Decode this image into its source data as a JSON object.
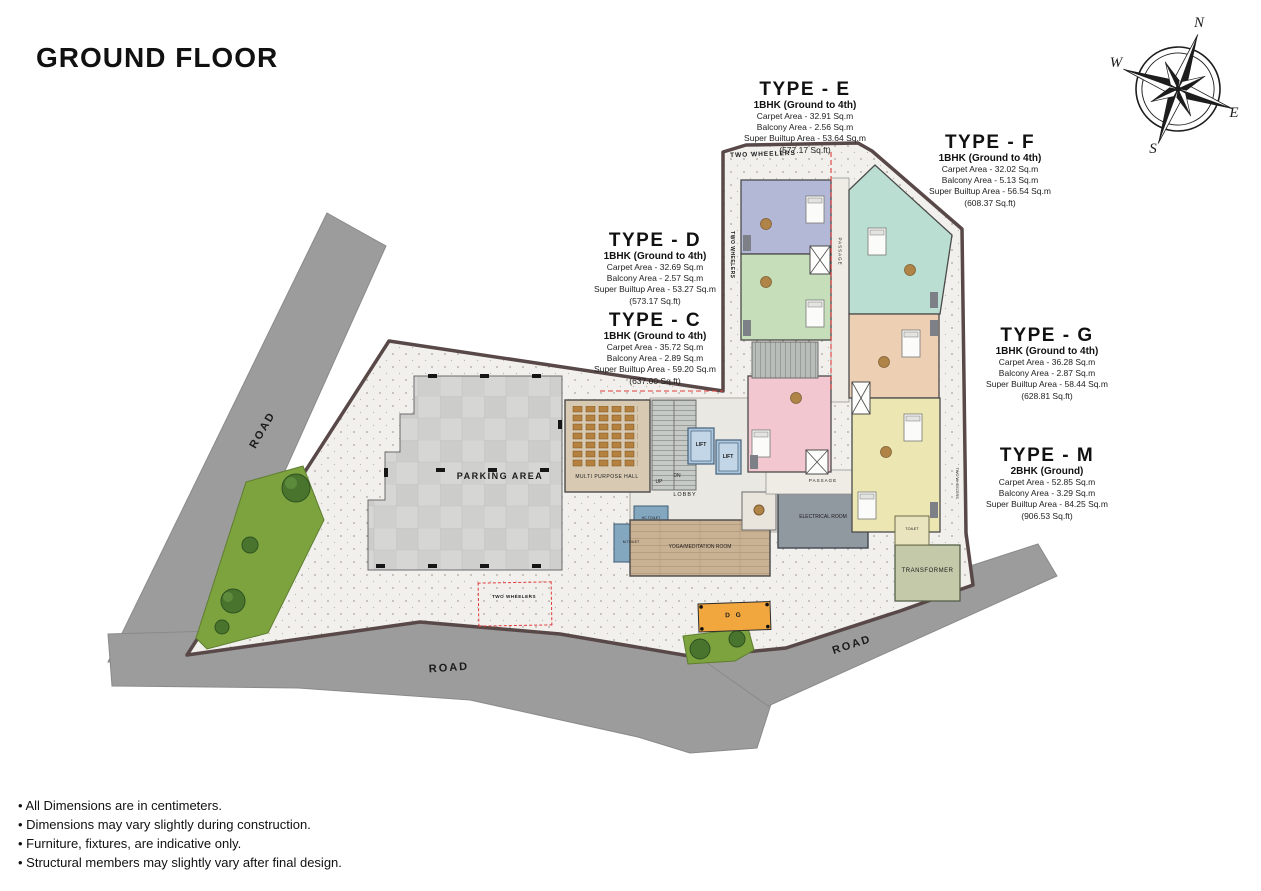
{
  "page": {
    "title": "GROUND FLOOR"
  },
  "compass": {
    "n": "N",
    "e": "E",
    "s": "S",
    "w": "W"
  },
  "types": [
    {
      "name": "TYPE - E",
      "subtitle": "1BHK (Ground to 4th)",
      "carpet": "Carpet Area - 32.91 Sq.m",
      "balcony": "Balcony Area - 2.56 Sq.m",
      "builtup": "Super Builtup Area - 53.64 Sq.m",
      "sqft": "(577.17 Sq.ft)"
    },
    {
      "name": "TYPE - F",
      "subtitle": "1BHK (Ground to 4th)",
      "carpet": "Carpet Area - 32.02 Sq.m",
      "balcony": "Balcony Area - 5.13 Sq.m",
      "builtup": "Super Builtup Area - 56.54 Sq.m",
      "sqft": "(608.37 Sq.ft)"
    },
    {
      "name": "TYPE - D",
      "subtitle": "1BHK (Ground to 4th)",
      "carpet": "Carpet Area - 32.69 Sq.m",
      "balcony": "Balcony Area - 2.57 Sq.m",
      "builtup": "Super Builtup Area - 53.27 Sq.m",
      "sqft": "(573.17 Sq.ft)"
    },
    {
      "name": "TYPE - C",
      "subtitle": "1BHK (Ground to 4th)",
      "carpet": "Carpet Area - 35.72 Sq.m",
      "balcony": "Balcony Area - 2.89 Sq.m",
      "builtup": "Super Builtup Area - 59.20 Sq.m",
      "sqft": "(637.00 Sq.ft)"
    },
    {
      "name": "TYPE - G",
      "subtitle": "1BHK (Ground to 4th)",
      "carpet": "Carpet Area - 36.28 Sq.m",
      "balcony": "Balcony Area - 2.87 Sq.m",
      "builtup": "Super Builtup Area - 58.44 Sq.m",
      "sqft": "(628.81 Sq.ft)"
    },
    {
      "name": "TYPE - M",
      "subtitle": "2BHK (Ground)",
      "carpet": "Carpet Area - 52.85 Sq.m",
      "balcony": "Balcony Area - 3.29 Sq.m",
      "builtup": "Super Builtup Area - 84.25 Sq.m",
      "sqft": "(906.53 Sq.ft)"
    }
  ],
  "plan": {
    "parking": "PARKING AREA",
    "hall": "MULTI PURPOSE HALL",
    "lift": "LIFT",
    "lobby": "LOBBY",
    "up": "UP",
    "dn": "DN",
    "passage": "PASSAGE",
    "yoga": "YOGA/MEDITATION ROOM",
    "electrical": "ELECTRICAL ROOM",
    "transformer": "TRANSFORMER",
    "toilet": "TOILET",
    "hc_toilet": "HC TOILET",
    "m_toilet": "M.TOILET",
    "dg": "D G",
    "two_wheelers": "TWO WHEELERS",
    "road": "ROAD"
  },
  "notes": [
    "• All Dimensions are in centimeters.",
    "• Dimensions may vary slightly during construction.",
    "• Furniture, fixtures, are indicative only.",
    "• Structural members may slightly vary after final design."
  ],
  "colors": {
    "road": "#9c9c9c",
    "ground": "#f1f0ec",
    "boundary": "#594848",
    "unit_e": "#b4b8d7",
    "unit_d": "#c6dfba",
    "unit_f": "#badfd2",
    "unit_g": "#edcfb4",
    "unit_c": "#f2c7cf",
    "unit_m": "#ece7b2",
    "lift": "#adc6dc",
    "electrical": "#9098a0",
    "transformer": "#c3c9a9",
    "dg": "#f2a63e",
    "green": "#7da33f",
    "red_marking": "#e03a3a"
  }
}
